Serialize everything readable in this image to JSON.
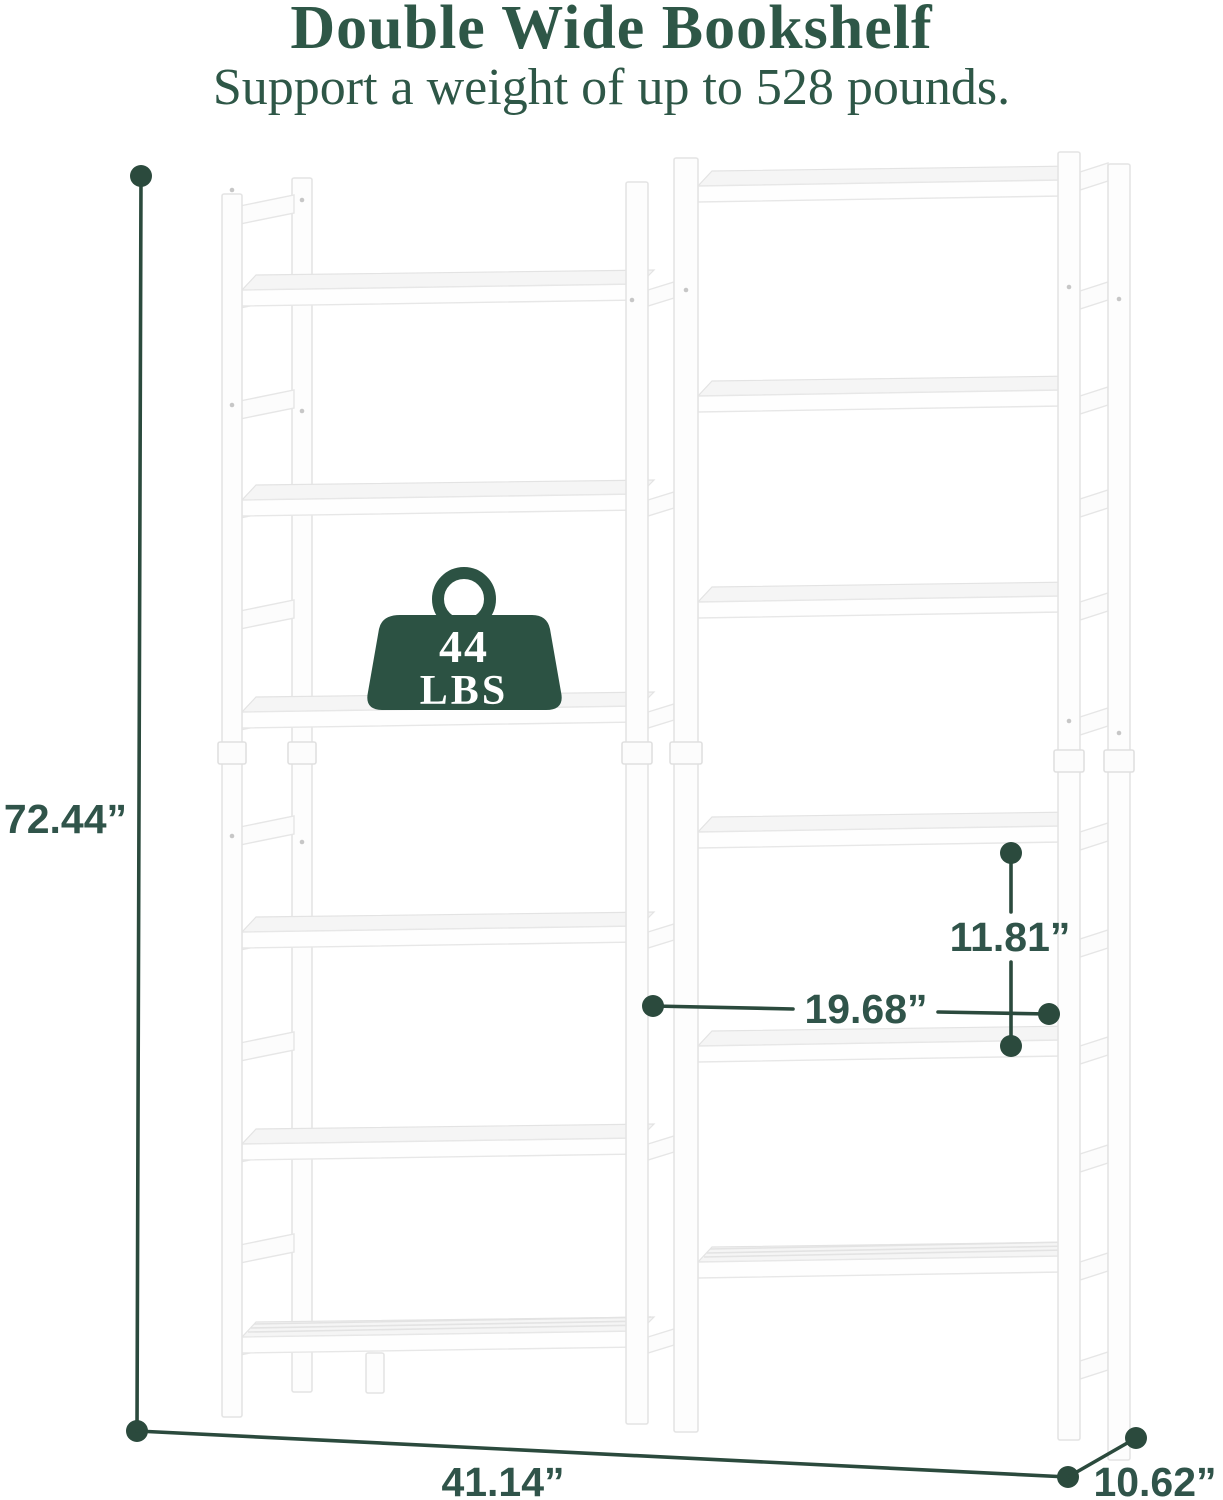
{
  "header": {
    "title": "Double Wide Bookshelf",
    "subtitle": "Support a weight of up to 528 pounds."
  },
  "weight_badge": {
    "value": "44",
    "unit": "LBS"
  },
  "dimensions": {
    "height": "72.44”",
    "width": "41.14”",
    "depth": "10.62”",
    "shelf_spacing": "11.81”",
    "shelf_width": "19.68”"
  },
  "colors": {
    "accent_green": "#2e5747",
    "dimension_green": "#2b4a3d",
    "badge_green": "#2c5243"
  }
}
